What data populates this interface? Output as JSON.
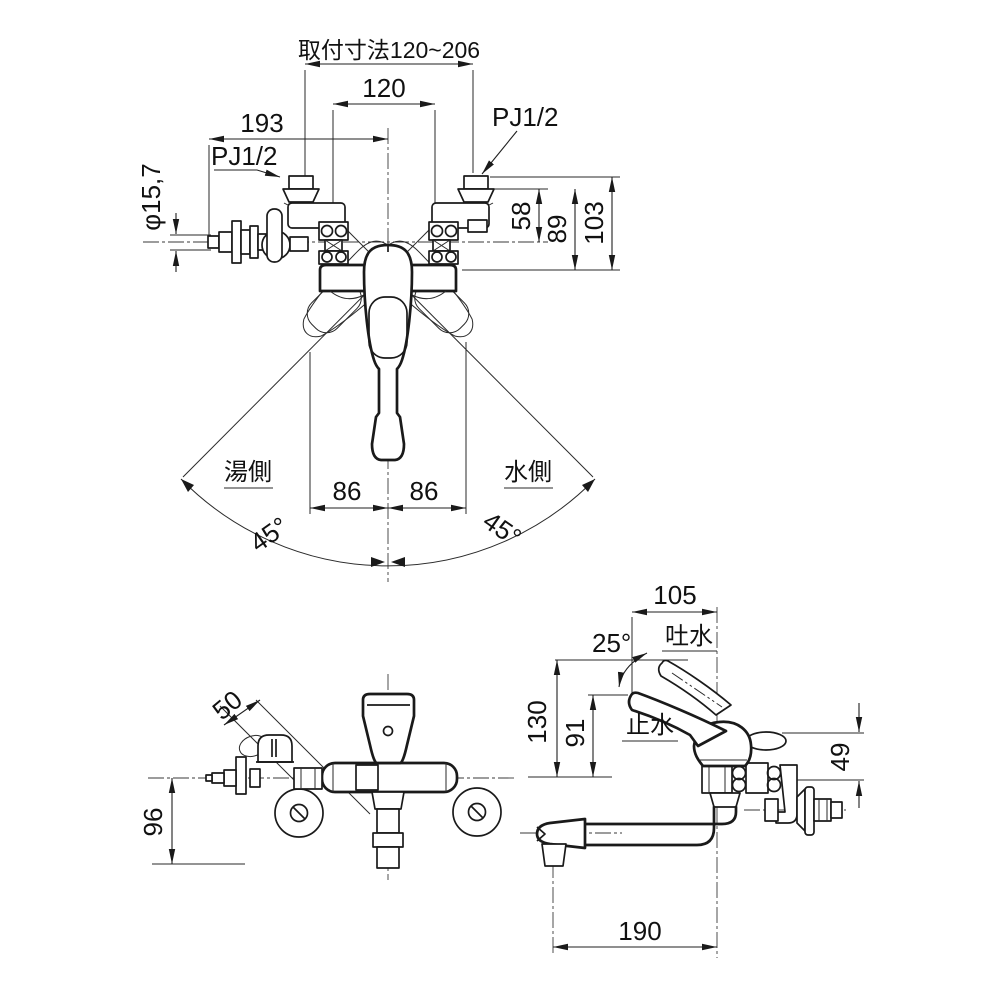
{
  "front_view": {
    "dim_mounting_range": "取付寸法120~206",
    "dim_pitch": "120",
    "dim_width": "193",
    "thread_left": "PJ1/2",
    "thread_right": "PJ1/2",
    "dim_tip_diameter": "φ15,7",
    "dim_58": "58",
    "dim_89": "89",
    "dim_103": "103",
    "label_hot_side": "湯側",
    "label_cold_side": "水側",
    "dim_86_left": "86",
    "dim_86_right": "86",
    "angle_left": "45°",
    "angle_right": "45°"
  },
  "plan_view": {
    "dim_50": "50",
    "dim_96": "96"
  },
  "side_view": {
    "dim_105": "105",
    "angle_25": "25°",
    "label_discharge": "吐水",
    "label_stop": "止水",
    "dim_130": "130",
    "dim_91": "91",
    "dim_49": "49",
    "dim_190": "190"
  },
  "colors": {
    "line": "#1a1a1a",
    "background": "#ffffff"
  }
}
